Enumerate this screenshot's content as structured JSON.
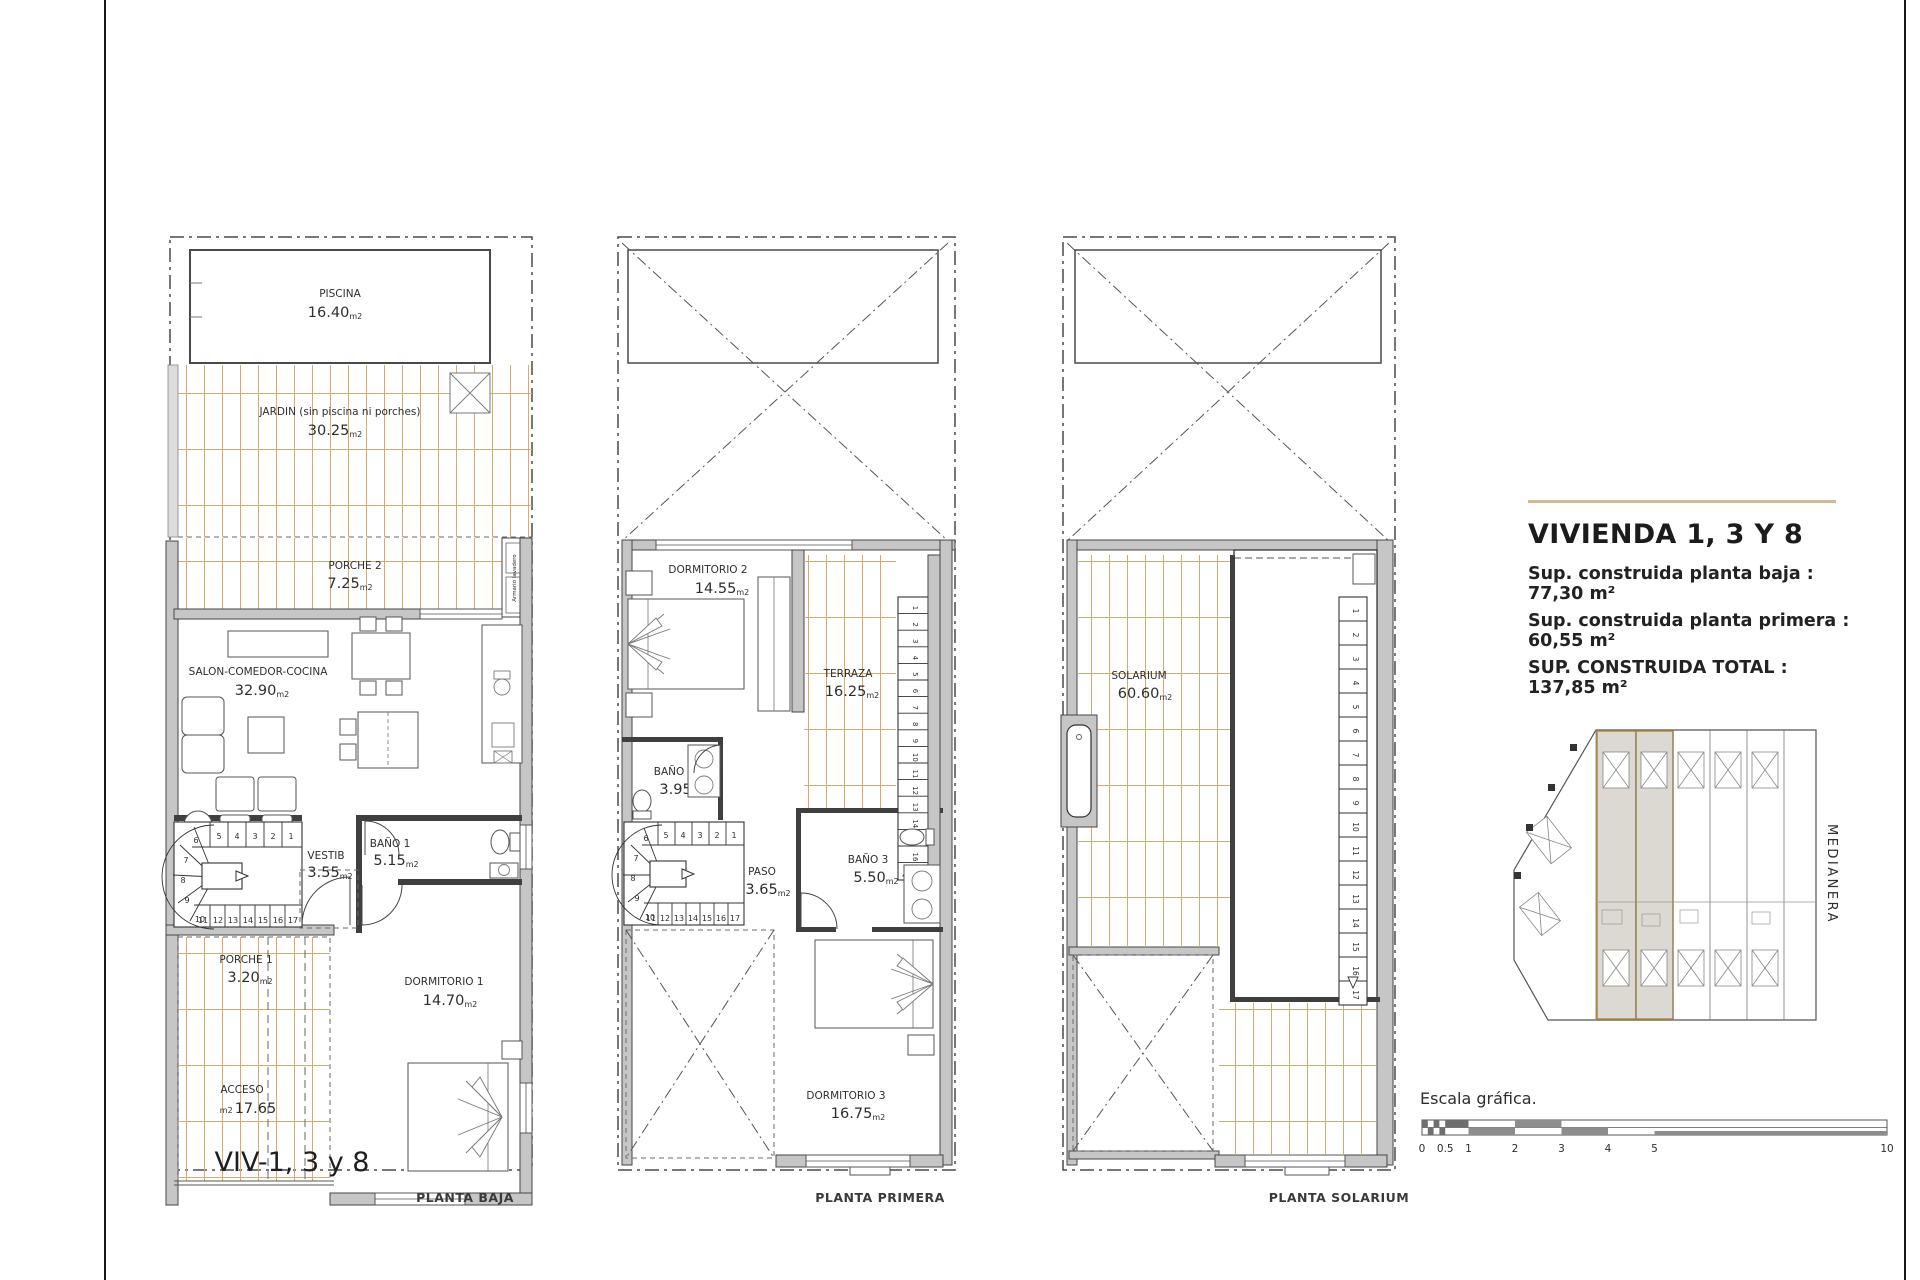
{
  "units": {
    "m2": "m2"
  },
  "colors": {
    "deck_line": "#d8ab6c",
    "wall_fill": "#c6c6c6",
    "accent_rule": "#cdbd92",
    "highlight_outline": "#b9893c"
  },
  "plans": {
    "baja": {
      "caption": "PLANTA BAJA",
      "viv_label": "VIV-1, 3 y 8",
      "rooms": {
        "piscina": {
          "name": "PISCINA",
          "area": "16.40"
        },
        "jardin": {
          "name": "JARDIN (sin piscina ni porches)",
          "area": "30.25"
        },
        "porche2": {
          "name": "PORCHE 2",
          "area": "7.25"
        },
        "armario": {
          "name": "Armario lavadero"
        },
        "salon": {
          "name": "SALON-COMEDOR-COCINA",
          "area": "32.90"
        },
        "vestib": {
          "name": "VESTIB",
          "area": "3.55"
        },
        "bano1": {
          "name": "BAÑO 1",
          "area": "5.15"
        },
        "porche1": {
          "name": "PORCHE 1",
          "area": "3.20"
        },
        "acceso": {
          "name": "ACCESO",
          "area": "17.65"
        },
        "dormitorio1": {
          "name": "DORMITORIO 1",
          "area": "14.70"
        }
      }
    },
    "primera": {
      "caption": "PLANTA PRIMERA",
      "rooms": {
        "dormitorio2": {
          "name": "DORMITORIO 2",
          "area": "14.55"
        },
        "terraza": {
          "name": "TERRAZA",
          "area": "16.25"
        },
        "bano2": {
          "name": "BAÑO 2",
          "area": "3.95"
        },
        "paso": {
          "name": "PASO",
          "area": "3.65"
        },
        "bano3": {
          "name": "BAÑO 3",
          "area": "5.50"
        },
        "dormitorio3": {
          "name": "DORMITORIO 3",
          "area": "16.75"
        }
      }
    },
    "solarium": {
      "caption": "PLANTA SOLARIUM",
      "rooms": {
        "solarium": {
          "name": "SOLARIUM",
          "area": "60.60"
        }
      }
    }
  },
  "stairs": {
    "upper_run": [
      "5",
      "4",
      "3",
      "2",
      "1"
    ],
    "curve": [
      "6",
      "7",
      "8",
      "9",
      "10"
    ],
    "lower_run": [
      "11",
      "12",
      "13",
      "14",
      "15",
      "16",
      "17"
    ],
    "straight_run": [
      "1",
      "2",
      "3",
      "4",
      "5",
      "6",
      "7",
      "8",
      "9",
      "10",
      "11",
      "12",
      "13",
      "14",
      "15",
      "16",
      "17"
    ]
  },
  "info": {
    "title": "VIVIENDA 1, 3 Y 8",
    "line1": "Sup. construida planta baja : 77,30 m²",
    "line2": "Sup. construida planta primera : 60,55 m²",
    "line3": "SUP. CONSTRUIDA TOTAL : 137,85 m²"
  },
  "site_plan": {
    "medianera": "MEDIANERA"
  },
  "scale_bar": {
    "label": "Escala gráfica.",
    "ticks": [
      "0",
      "0.5",
      "1",
      "2",
      "3",
      "4",
      "5",
      "10"
    ]
  }
}
